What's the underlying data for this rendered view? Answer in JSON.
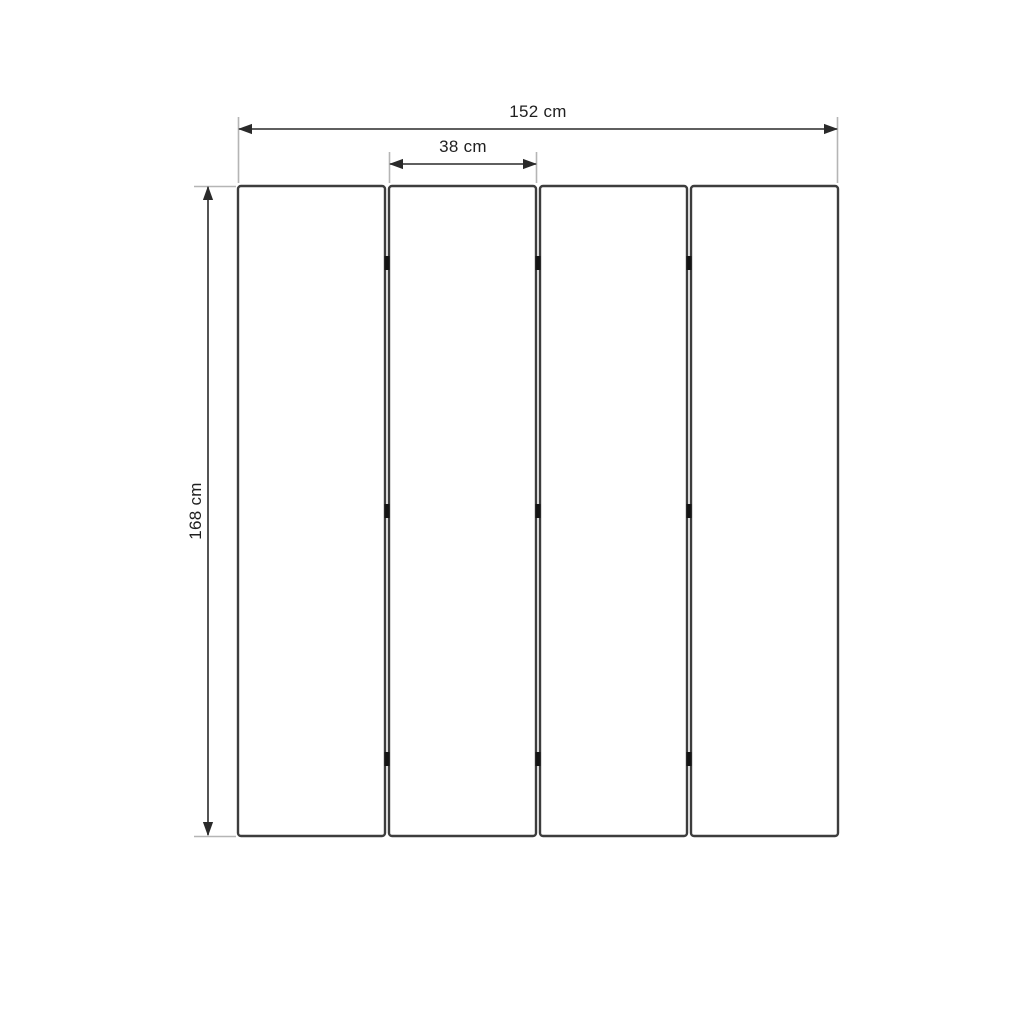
{
  "diagram": {
    "panel_count": 4,
    "labels": {
      "total_width": "152 cm",
      "panel_width": "38 cm",
      "height": "168 cm"
    },
    "colors": {
      "background": "#ffffff",
      "panel_stroke": "#3d3d3d",
      "panel_fill": "#ffffff",
      "dimension_line": "#2a2a2a",
      "extension_line": "#b5b5b5",
      "hinge": "#141414",
      "label_text": "#1f1f1f"
    }
  }
}
